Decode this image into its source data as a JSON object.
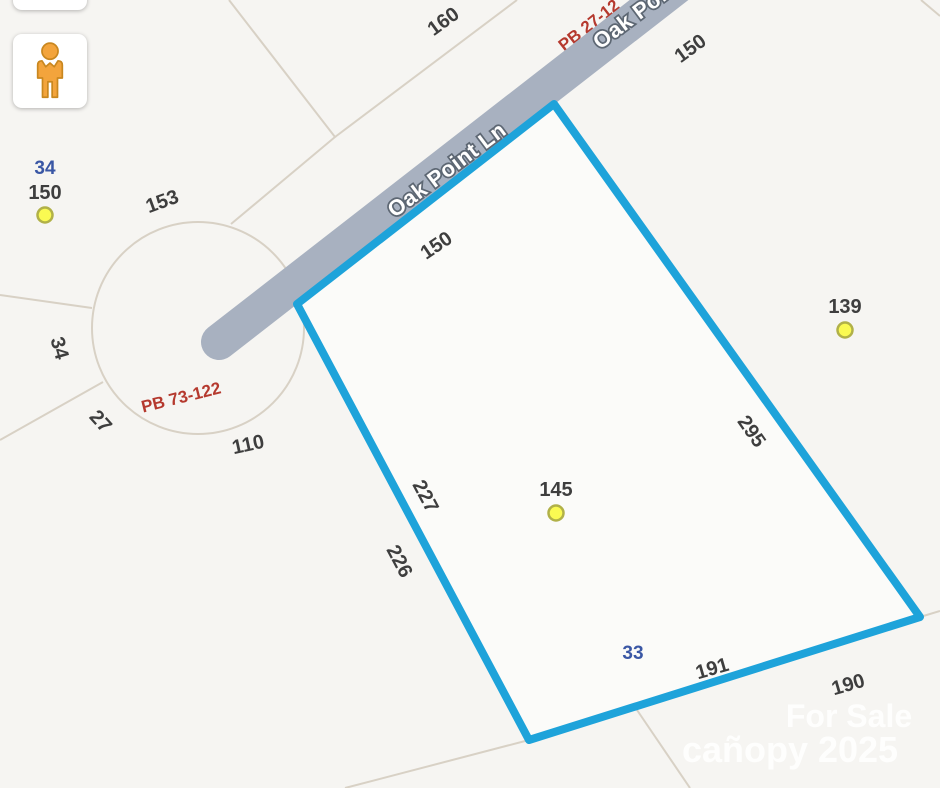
{
  "map": {
    "road": {
      "name": "Oak Point Ln",
      "name_clipped_top": "Oak Point Ln"
    },
    "plat_references": {
      "culdesac": "PB 73-122",
      "upper_road": "PB 27-12"
    },
    "parcel_ids": {
      "adjacent_west": "34",
      "selected": "33"
    },
    "dimensions": {
      "d160": "160",
      "d150_upper_right": "150",
      "d150_west": "150",
      "d150_road_frontage": "150",
      "d153": "153",
      "d139": "139",
      "d34_side": "34",
      "d27": "27",
      "d110": "110",
      "d295": "295",
      "d227": "227",
      "d226": "226",
      "d145": "145",
      "d191": "191",
      "d190": "190"
    },
    "address_point_count": "3"
  },
  "watermark": {
    "line1": "For Sale",
    "line2": "cañopy 2025"
  },
  "controls": {
    "pegman_tooltip": "Street View"
  },
  "colors": {
    "background": "#f6f5f2",
    "parcel_line": "#d8d1c5",
    "road_fill": "#a8b1c0",
    "road_text": "#ffffff",
    "road_text_halo": "#5d6773",
    "parcel_highlight": "#1ea3da",
    "selected_fill": "rgba(255,255,255,0.55)",
    "plat_ref_red": "#b5392e",
    "parcel_id_blue": "#3a57a5",
    "label_dark": "#3e3e3e",
    "address_dot_fill": "#fafa52",
    "address_dot_stroke": "#b1b148",
    "pegman_orange": "#f3a43c"
  }
}
